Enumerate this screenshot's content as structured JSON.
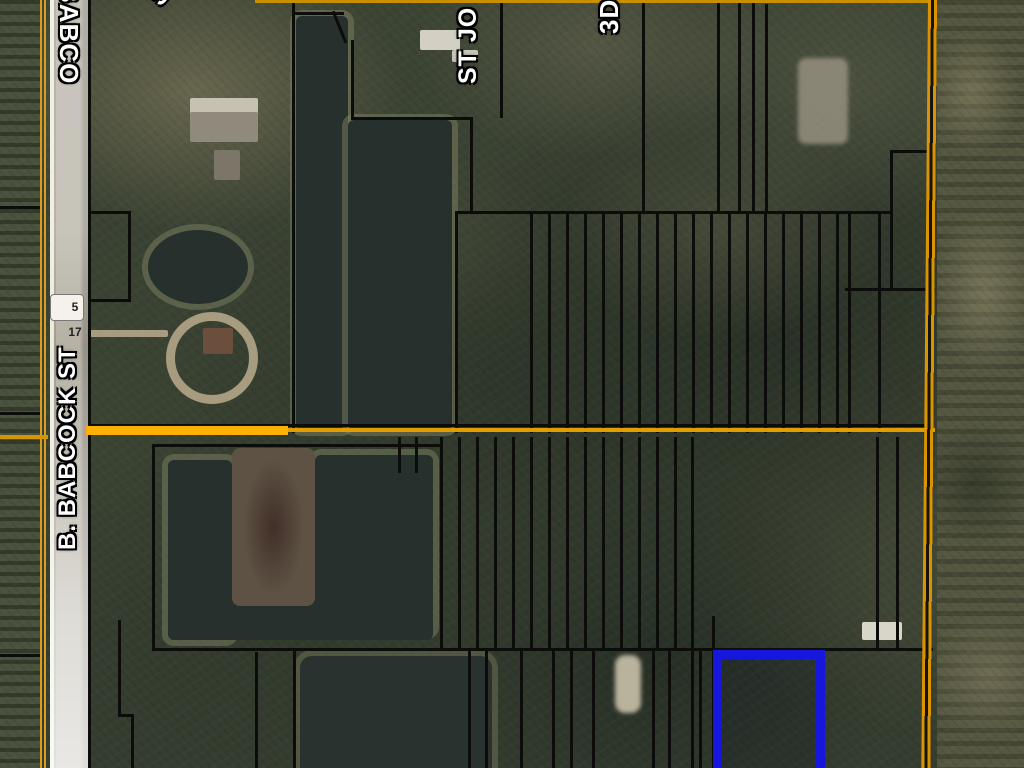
{
  "map": {
    "labels": {
      "road_top": "BABCO",
      "route_shield": "5 17",
      "road_main": "B. BABCOCK ST",
      "street_partial": "ST JO",
      "fragment_s": "S",
      "fragment_3d": "3D"
    },
    "colors": {
      "parcel_line": "#0c0c0a",
      "section_line": "#e29d00",
      "section_line_bright": "#ffb103",
      "highlight_parcel": "#1616dd",
      "water": "#26302c",
      "road_surface": "#b5b1a4",
      "label_text": "#ffffff"
    }
  }
}
